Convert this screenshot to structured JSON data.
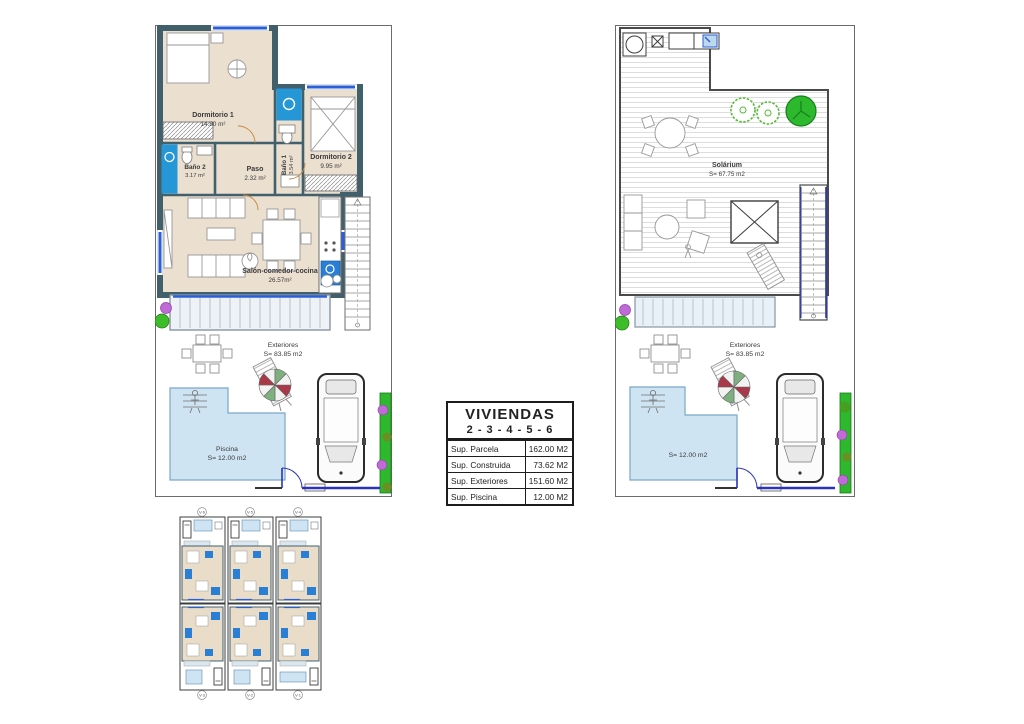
{
  "ground_floor": {
    "rooms": {
      "dormitorio1": {
        "name": "Dormitorio 1",
        "area": "14.80 m²"
      },
      "bano1": {
        "name": "Baño 1",
        "area": "3.54 m²"
      },
      "dormitorio2": {
        "name": "Dormitorio 2",
        "area": "9.95 m²"
      },
      "bano2": {
        "name": "Baño 2",
        "area": "3.17 m²"
      },
      "paso": {
        "name": "Paso",
        "area": "2.32 m²"
      },
      "salon": {
        "name": "Salón-comedor-cocina",
        "area": "26.57m²"
      }
    },
    "exterior": {
      "name": "Exteriores",
      "area": "S= 83.85 m2"
    },
    "pool": {
      "name": "Piscina",
      "area": "S= 12.00 m2"
    }
  },
  "roof_floor": {
    "solarium": {
      "name": "Solárium",
      "area": "S= 67.75 m2"
    },
    "exterior": {
      "name": "Exteriores",
      "area": "S= 83.85 m2"
    },
    "pool": {
      "area": "S= 12.00 m2"
    }
  },
  "spec_table": {
    "title": "VIVIENDAS",
    "subtitle": "2 - 3 - 4 - 5 - 6",
    "rows": [
      {
        "label": "Sup. Parcela",
        "value": "162.00 M2"
      },
      {
        "label": "Sup. Construida",
        "value": "73.62 M2"
      },
      {
        "label": "Sup. Exteriores",
        "value": "151.60 M2"
      },
      {
        "label": "Sup. Piscina",
        "value": "12.00 M2"
      }
    ]
  },
  "site_plan": {
    "units": [
      {
        "label": "V-6"
      },
      {
        "label": "V-5"
      },
      {
        "label": "V-4"
      },
      {
        "label": "V-3"
      },
      {
        "label": "V-2"
      },
      {
        "label": "V-1"
      }
    ]
  },
  "colors": {
    "wall": "#41606c",
    "floor": "#ebdfd0",
    "bath_water": "#2596d6",
    "pool_water": "#cfe4f2",
    "glass_blue": "#2b5fd9",
    "hedge_green": "#2eb82e",
    "flower_violet": "#c06ad6",
    "door_swing": "#c8863c"
  }
}
